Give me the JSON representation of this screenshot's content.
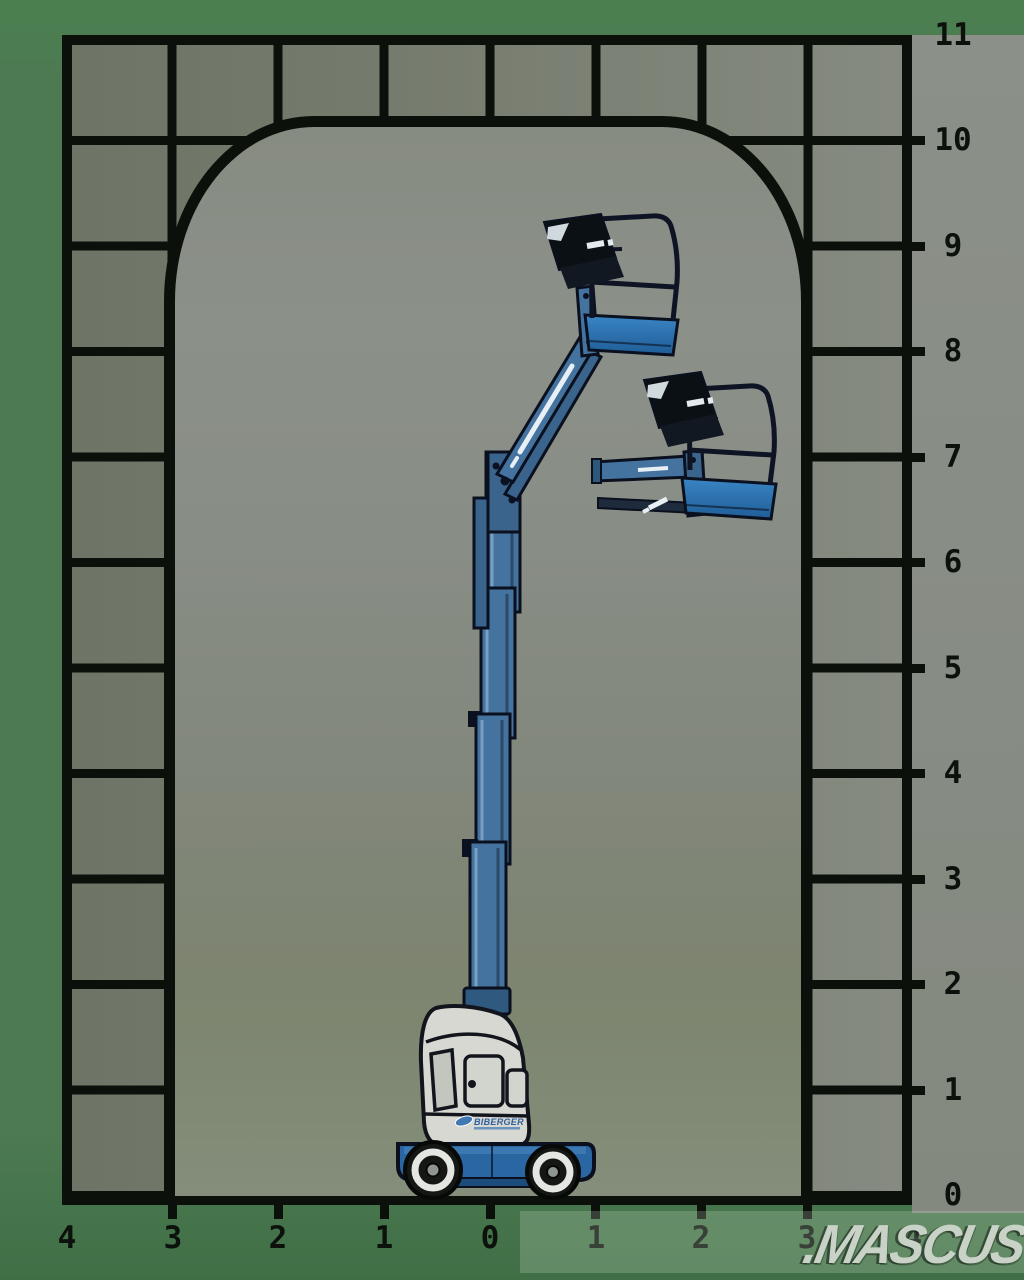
{
  "diagram": {
    "description": "Working envelope / reach diagram of a blue vertical-mast articulating boom lift shown at two platform positions inside a gridded arch"
  },
  "right_axis": {
    "labels": [
      "11",
      "10",
      "9",
      "8",
      "7",
      "6",
      "5",
      "4",
      "3",
      "2",
      "1",
      "0"
    ]
  },
  "bottom_axis": {
    "labels": [
      "4",
      "3",
      "2",
      "1",
      "0",
      "1",
      "2",
      "3",
      "4"
    ]
  },
  "watermark": {
    "text": ".MASCUS"
  },
  "machine": {
    "logo_text": "BIBERGER"
  },
  "colors": {
    "background_green": "#4d7a52",
    "field_gray": "#888d85",
    "grid_black": "#0b100b",
    "machine_blue": "#45739f",
    "platform_floor_blue": "#2f79b8",
    "cowling_white": "#d7d8d2",
    "watermark_gray": "#c8d2c6"
  },
  "chart_data": {
    "type": "area",
    "title": "",
    "xlabel": "",
    "ylabel": "",
    "x_axis_ticks": [
      -4,
      -3,
      -2,
      -1,
      0,
      1,
      2,
      3,
      4
    ],
    "y_axis_ticks": [
      0,
      1,
      2,
      3,
      4,
      5,
      6,
      7,
      8,
      9,
      10,
      11
    ],
    "grid": true,
    "envelope_outline_m": [
      [
        -3,
        0
      ],
      [
        -3,
        8.5
      ],
      [
        -1.7,
        10.2
      ],
      [
        1.75,
        10.2
      ],
      [
        3,
        8.4
      ],
      [
        3,
        0
      ]
    ],
    "platform_positions_m": [
      {
        "name": "raised",
        "platform_floor_height": 8.2,
        "outreach": 1.2
      },
      {
        "name": "mid-outreach",
        "platform_floor_height": 6.7,
        "outreach": 2.2
      }
    ]
  }
}
